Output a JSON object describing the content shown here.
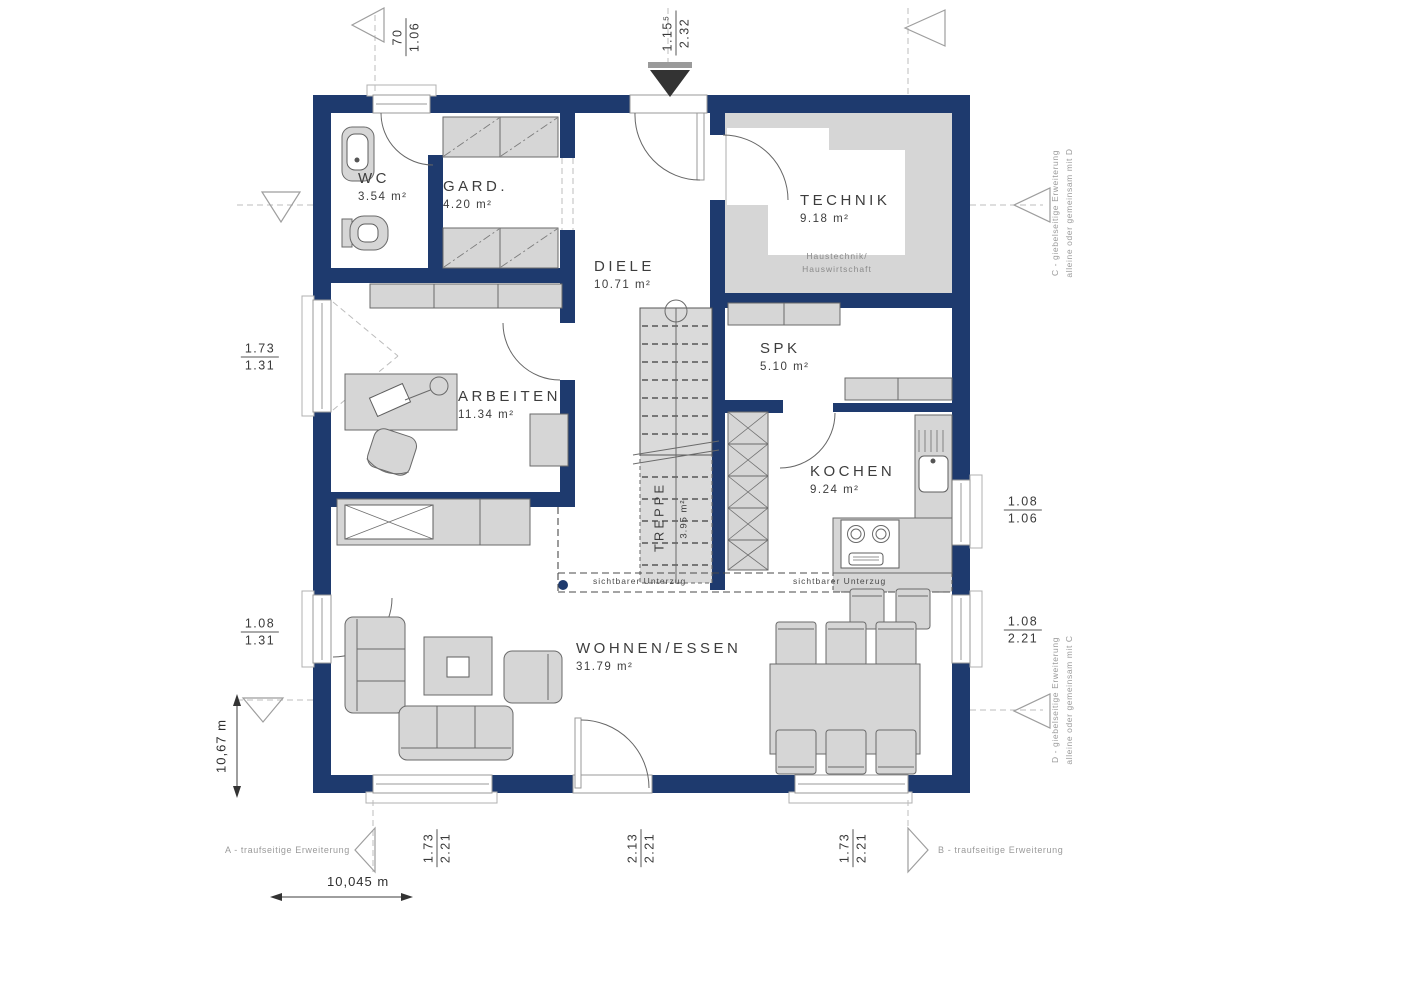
{
  "rooms": {
    "wc": {
      "name": "WC",
      "area": "3.54 m²"
    },
    "gard": {
      "name": "GARD.",
      "area": "4.20 m²"
    },
    "diele": {
      "name": "DIELE",
      "area": "10.71 m²"
    },
    "technik": {
      "name": "TECHNIK",
      "area": "9.18 m²",
      "caption_line1": "Haustechnik/",
      "caption_line2": "Hauswirtschaft"
    },
    "spk": {
      "name": "SPK",
      "area": "5.10 m²"
    },
    "kochen": {
      "name": "KOCHEN",
      "area": "9.24 m²"
    },
    "arbeiten": {
      "name": "ARBEITEN",
      "area": "11.34 m²"
    },
    "wohnen": {
      "name": "WOHNEN/ESSEN",
      "area": "31.79 m²"
    },
    "treppe": {
      "name": "TREPPE",
      "area": "3.95 m²"
    }
  },
  "annotations": {
    "unterzug_left": "sichtbarer Unterzug",
    "unterzug_right": "sichtbarer Unterzug",
    "extension_a": "A - traufseitige Erweiterung",
    "extension_b": "B - traufseitige Erweiterung",
    "extension_c_line1": "C - giebelseitige Erweiterung",
    "extension_c_line2": "alleine oder gemeinsam mit D",
    "extension_d_line1": "D - giebelseitige Erweiterung",
    "extension_d_line2": "alleine oder gemeinsam mit C"
  },
  "dimensions": {
    "top_left": {
      "top": "70",
      "bottom": "1.06"
    },
    "top_mid": {
      "top": "1.15⁵",
      "bottom": "2.32"
    },
    "left_upper": {
      "top": "1.73",
      "bottom": "1.31"
    },
    "left_lower": {
      "top": "1.08",
      "bottom": "1.31"
    },
    "right_upper": {
      "top": "1.08",
      "bottom": "1.06"
    },
    "right_lower": {
      "top": "1.08",
      "bottom": "2.21"
    },
    "bottom_left": {
      "top": "1.73",
      "bottom": "2.21"
    },
    "bottom_mid": {
      "top": "2.13",
      "bottom": "2.21"
    },
    "bottom_right": {
      "top": "1.73",
      "bottom": "2.21"
    },
    "width_total": "10,045 m",
    "height_total": "10,67 m"
  },
  "colors": {
    "wall": "#1e3a6e",
    "furniture": "#d6d6d6",
    "text": "#3d3d3d"
  }
}
